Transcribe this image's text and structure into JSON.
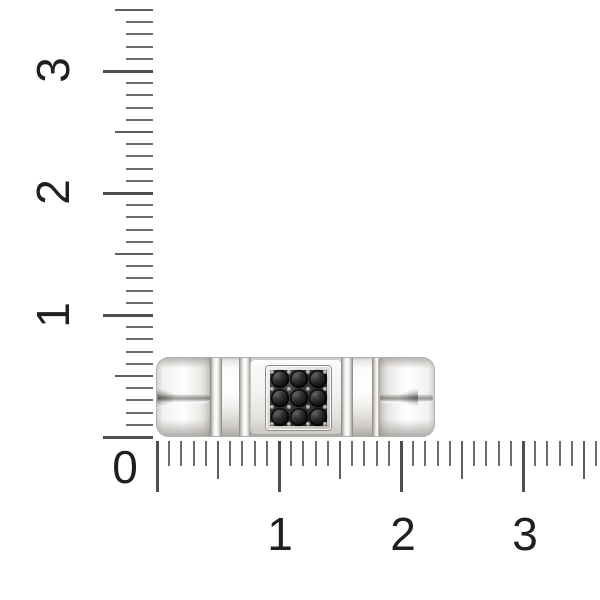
{
  "scene": {
    "background": "#ffffff",
    "subject": "white-gold ring band with square pave cluster of 3x3 round black gems, photographed against centimeter rulers",
    "canvas": {
      "width": 600,
      "height": 600
    }
  },
  "palette": {
    "tick_minor": "#6f6d68",
    "tick_medium": "#605e59",
    "tick_major": "#504e49",
    "number_color": "#1f1f1f",
    "metal_light": "#ffffff",
    "metal_shadow": "#b0adaa",
    "plate_inner": "#2f2f2f",
    "gem_color": "#141414",
    "prong_color": "#a8a6a2"
  },
  "rulers": {
    "origin_label": "0",
    "minor_spacing_px": 12.2,
    "unit_px": 122,
    "vertical": {
      "axis_x": 153,
      "zero_y": 437,
      "tick_count": 36,
      "minor_len": 27,
      "medium_len": 38,
      "major_len": 50,
      "labels": [
        {
          "text": "1",
          "y": 315
        },
        {
          "text": "2",
          "y": 192
        },
        {
          "text": "3",
          "y": 70
        }
      ],
      "label_x": 53
    },
    "horizontal": {
      "axis_y": 441,
      "zero_x": 157,
      "tick_count": 37,
      "minor_len": 25,
      "medium_len": 38,
      "major_len": 51,
      "labels": [
        {
          "text": "1",
          "x": 280
        },
        {
          "text": "2",
          "x": 403
        },
        {
          "text": "3",
          "x": 525
        }
      ],
      "label_y": 534
    },
    "origin": {
      "x": 125,
      "y": 467
    }
  },
  "ring": {
    "gem_grid": {
      "rows": 3,
      "cols": 3,
      "count": 9,
      "cell": 18.8,
      "gem_size": 18
    },
    "prong_grid": {
      "rows": 4,
      "cols": 4
    },
    "style": "flat link band: split rounded shoulders, vertical polished dividers, square black-gem signet center"
  }
}
